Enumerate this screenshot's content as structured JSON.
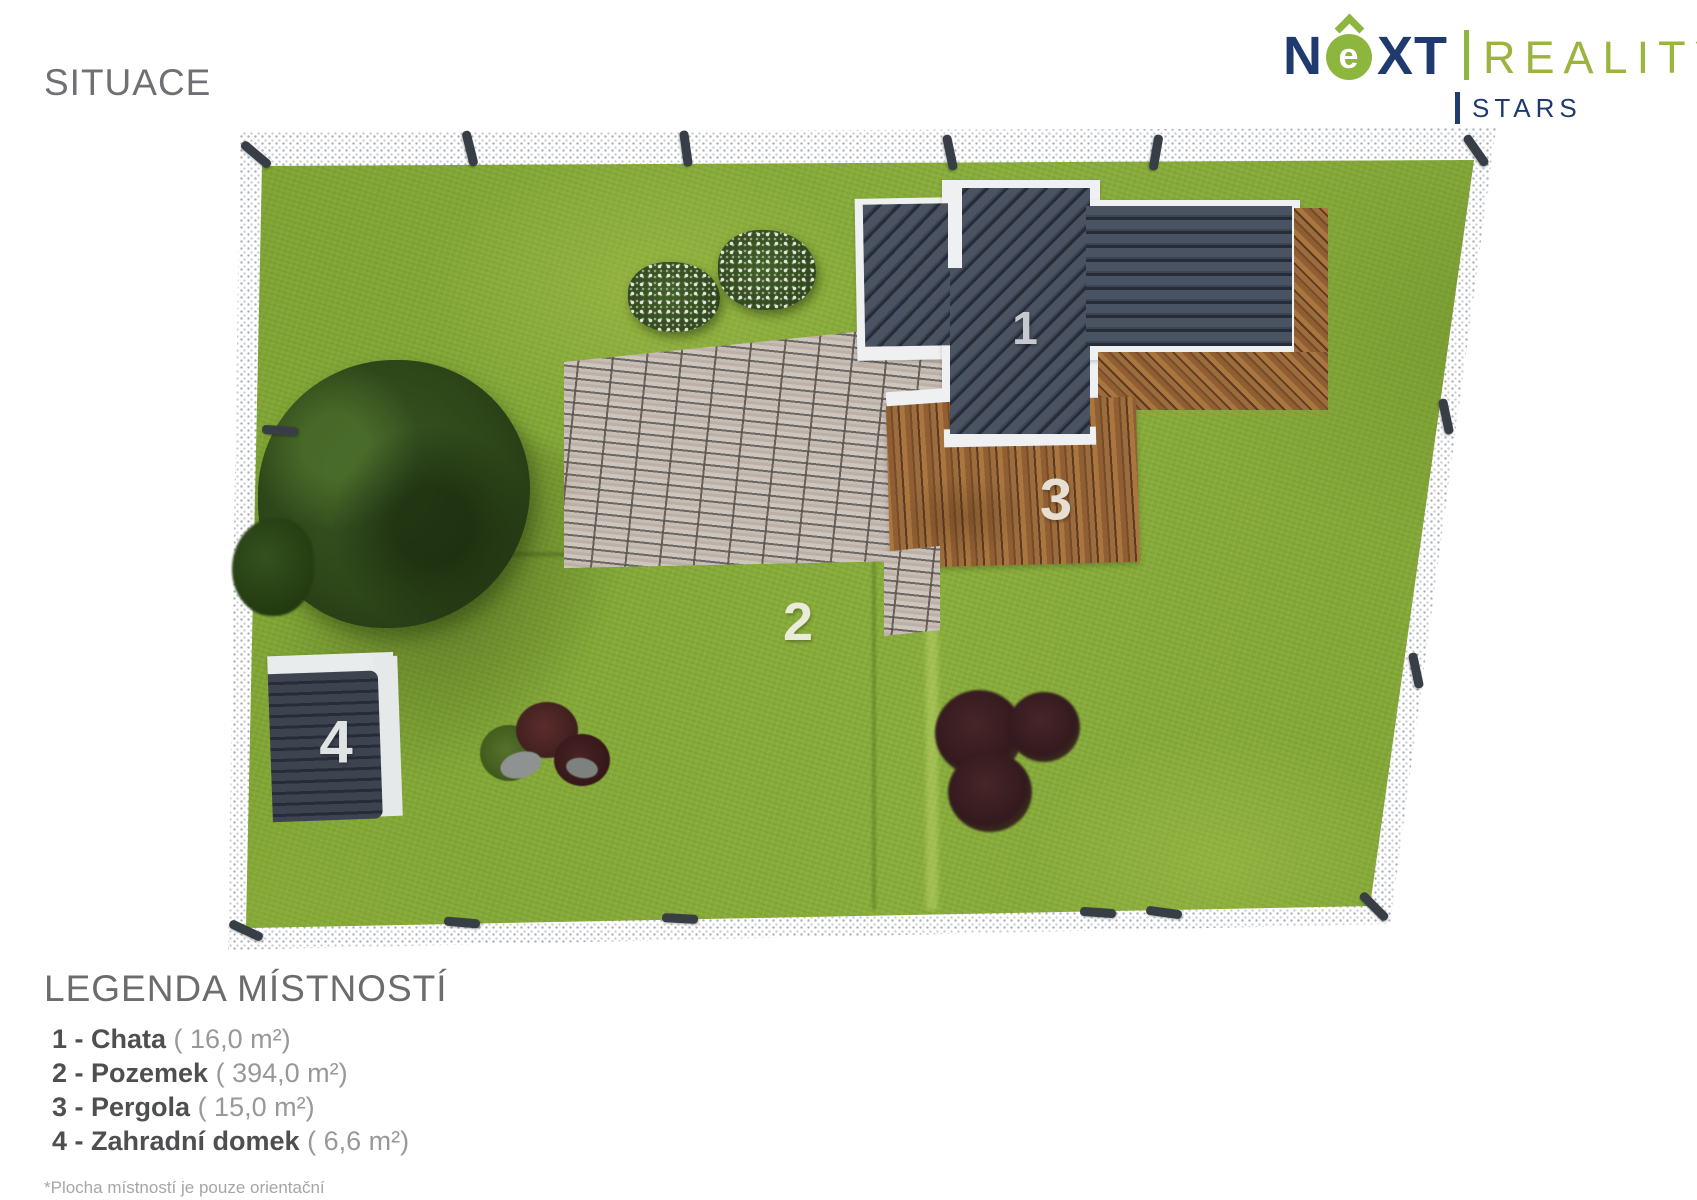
{
  "title": "SITUACE",
  "logo": {
    "brand_n": "N",
    "brand_e": "e",
    "brand_xt": "XT",
    "brand_secondary": "REALITY",
    "brand_sub": "STARS",
    "colors": {
      "brand_navy": "#1e3a6e",
      "brand_green": "#8cb63e"
    }
  },
  "plan": {
    "markers": [
      {
        "label": "1"
      },
      {
        "label": "2"
      },
      {
        "label": "3"
      },
      {
        "label": "4"
      }
    ],
    "colors": {
      "grass": "#83a937",
      "roof_slate": "#3f4754",
      "deck_wood": "#9a6b3f",
      "brick": "#b4aca7",
      "fence": "#ffffff"
    }
  },
  "legend": {
    "heading": "LEGENDA MÍSTNOSTÍ",
    "items": [
      {
        "label": "1 - Chata",
        "area": "( 16,0 m²)"
      },
      {
        "label": "2 - Pozemek",
        "area": "( 394,0 m²)"
      },
      {
        "label": "3 - Pergola",
        "area": "( 15,0 m²)"
      },
      {
        "label": "4 - Zahradní domek",
        "area": "( 6,6 m²)"
      }
    ],
    "footnote": "*Plocha místností je pouze orientační"
  }
}
